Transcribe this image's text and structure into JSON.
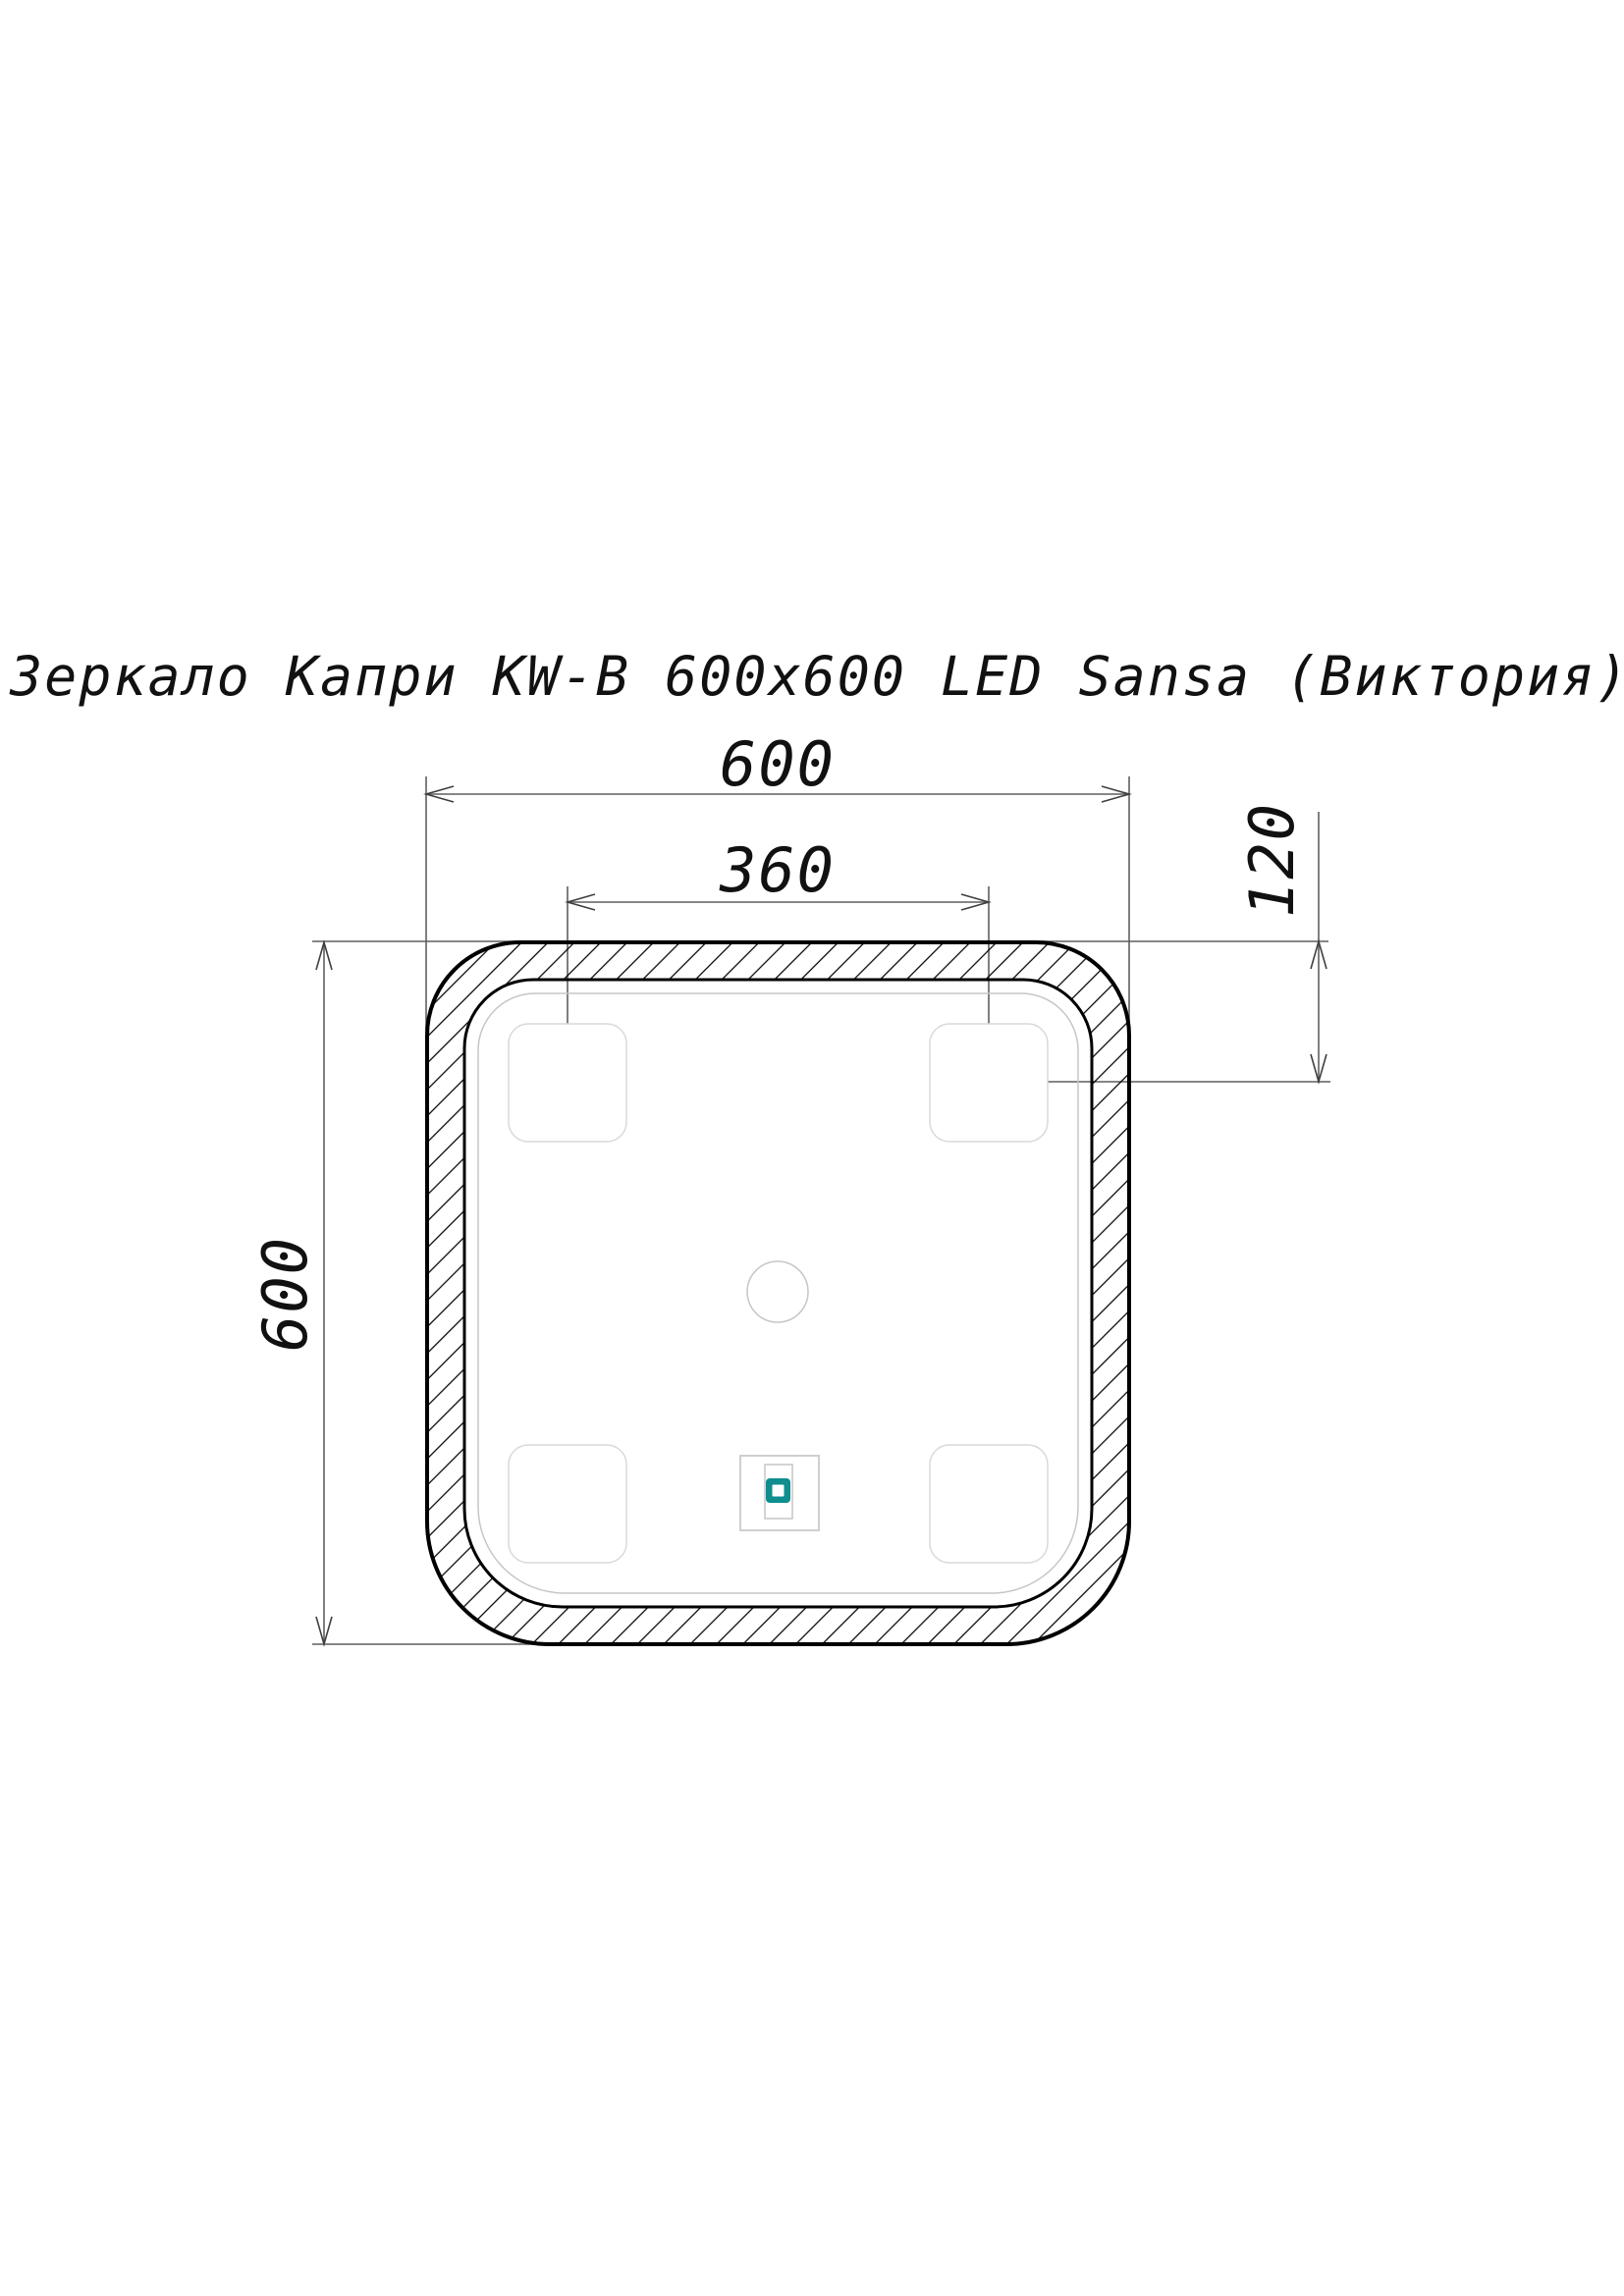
{
  "title": "Зеркало Капри KW-B 600x600 LED Sansa (Виктория)",
  "dimensions": {
    "overall_width": "600",
    "overall_height": "600",
    "led_pad_spacing": "360",
    "led_pad_offset": "120"
  },
  "icons": {
    "touch_sensor": "touch-sensor-icon"
  },
  "colors": {
    "background": "#ffffff",
    "outline": "#000000",
    "dimension_line": "#5f5f5f",
    "glass_line": "#c6c6c6",
    "pad_line": "#d9d9d9",
    "sensor_accent": "#0e8e8e",
    "text": "#111111"
  }
}
